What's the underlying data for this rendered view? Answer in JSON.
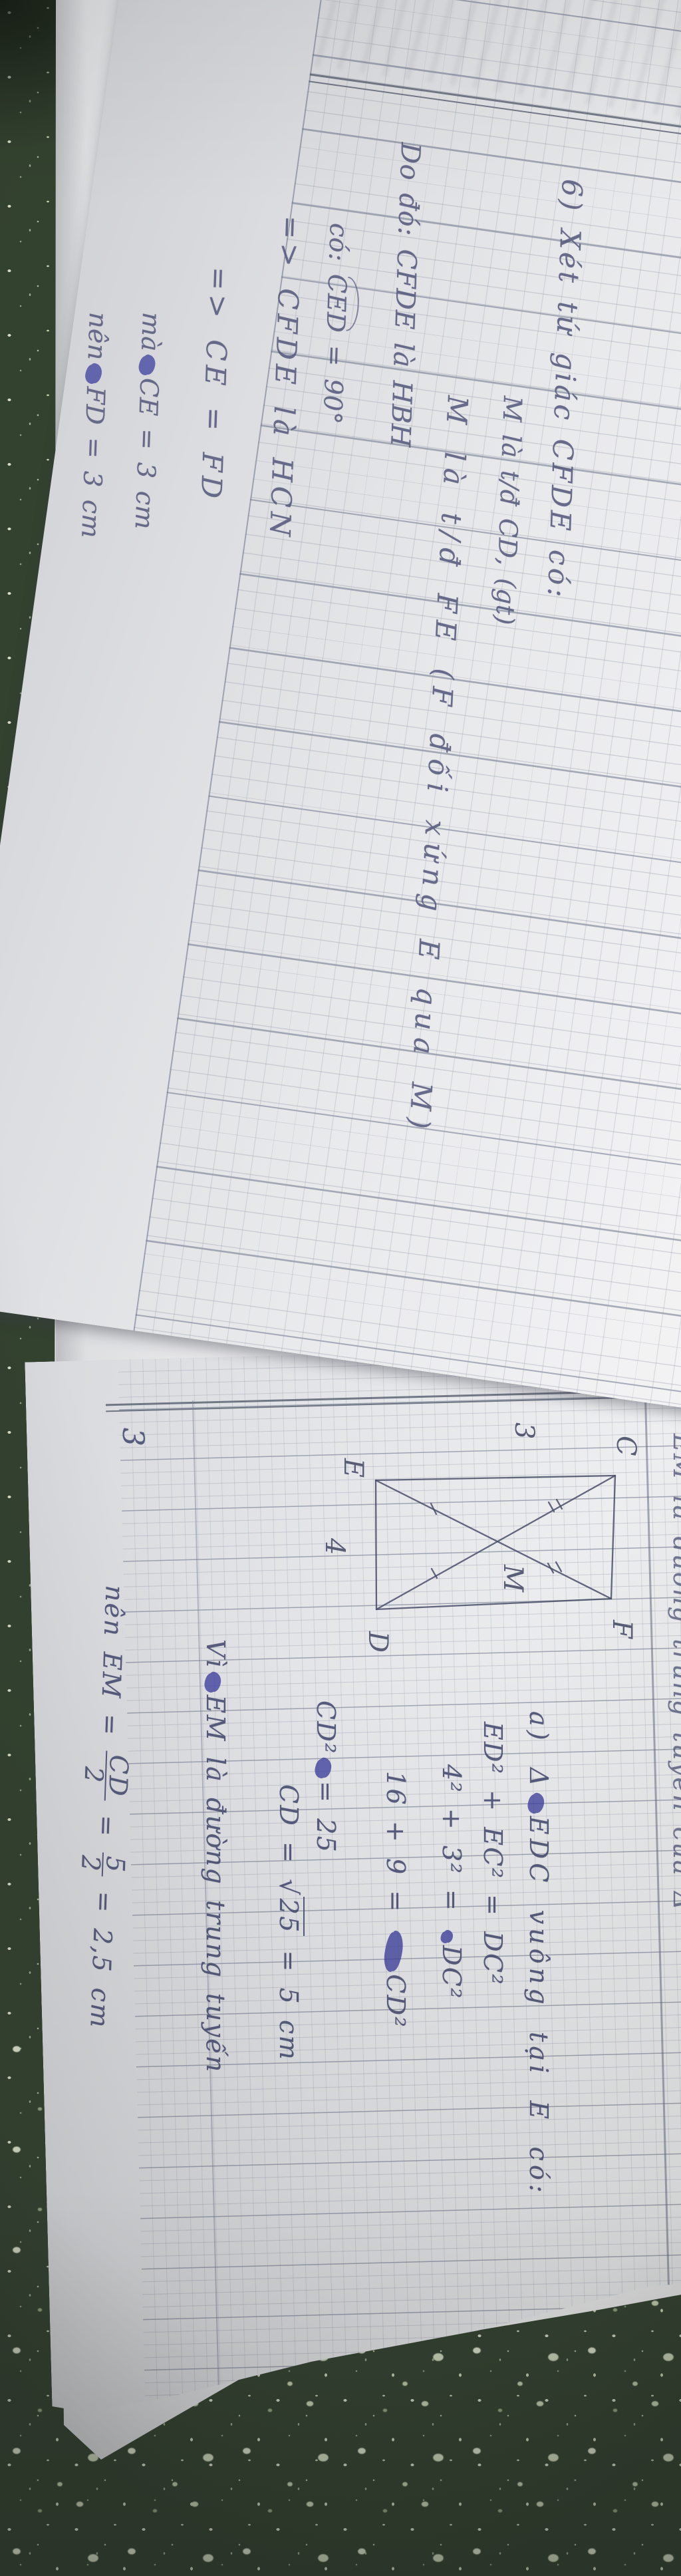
{
  "scene": {
    "description": "Photo of an open squared-paper notebook with handwritten Vietnamese geometry homework, lying on a dark green speckled table; the photo is rotated 90° so the handwriting runs top-to-bottom",
    "surface": "dark green speckled cloth"
  },
  "colors": {
    "table_green": "#33412f",
    "speckle": "#cfd8c0",
    "paper": "#e8e9eb",
    "grid_fine": "#9ba2b4",
    "grid_heavy": "#69728a",
    "ink_upper": "#565a7c",
    "ink_lower": "#4c5074",
    "ink_scribble": "#3c3f9e",
    "pencil_figure": "#4a4f6a"
  },
  "upper_page": {
    "u1": "6) Xét tứ giác CFDE có:",
    "u2": "M là t/đ CD, (gt)",
    "u3": "M là t/đ FE (F đối xứng E qua M)",
    "u4": "Do đó: CFDE là HBH",
    "u5_pre": "có: ",
    "u5_angle": "CED",
    "u5_post": " = 90°",
    "u6": "=> CFDE là HCN",
    "u7": "=> CE = FD",
    "u8_pre": "mà",
    "u8_post": "CE = 3 cm",
    "u9_pre": "nên",
    "u9_post": "FD = 3 cm"
  },
  "lower_page": {
    "problem_number": "3",
    "la_pre": "a) Δ",
    "la_post": "EDC vuông tại E có:",
    "lb": "ED² + EC² = DC²",
    "lc_pre": "4² + 3² = ",
    "lc_post": "DC²",
    "ld_pre": "16 + 9 = ",
    "ld_post": "CD²",
    "le_pre": "CD²",
    "le_post": "= 25",
    "lf_pre": "CD = ",
    "lf_rad": "25",
    "lf_post": " = 5 cm",
    "lg_pre": "Vì",
    "lg_post": "EM là đường trung tuyến",
    "lh": {
      "prefix": "nên EM = ",
      "f1n": "CD",
      "f1d": "2",
      "mid": " = ",
      "f2n": "5",
      "f2d": "2",
      "suffix": " = 2,5 cm"
    },
    "right_edge_fragment": "EM là đường trung tuyến của Δ",
    "figure": {
      "label_c": "C",
      "label_e": "E",
      "label_d": "D",
      "label_f": "F",
      "label_m": "M",
      "side_ec": "3",
      "side_ed": "4"
    }
  }
}
